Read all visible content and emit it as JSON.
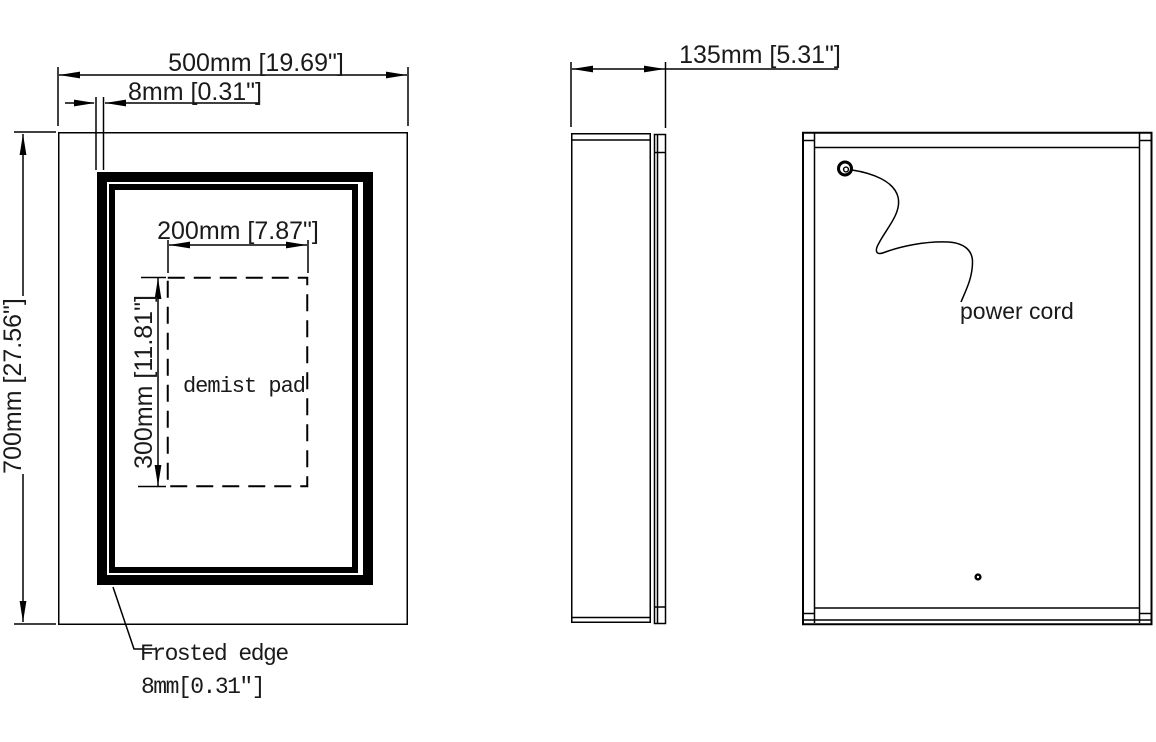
{
  "colors": {
    "line": "#000000",
    "background": "#ffffff",
    "text": "#1a1a1a"
  },
  "front_view": {
    "width_dim": "500mm [19.69\"]",
    "frosted_edge_dim": "8mm [0.31\"]",
    "height_dim": "700mm [27.56\"]",
    "pad_width_dim": "200mm [7.87\"]",
    "pad_height_dim": "300mm [11.81\"]",
    "pad_label": "demist pad",
    "frosted_callout_line1": "Frosted edge",
    "frosted_callout_line2": "8mm[0.31″]"
  },
  "side_view": {
    "depth_dim": "135mm [5.31\"]"
  },
  "back_view": {
    "cord_label": "power cord"
  }
}
